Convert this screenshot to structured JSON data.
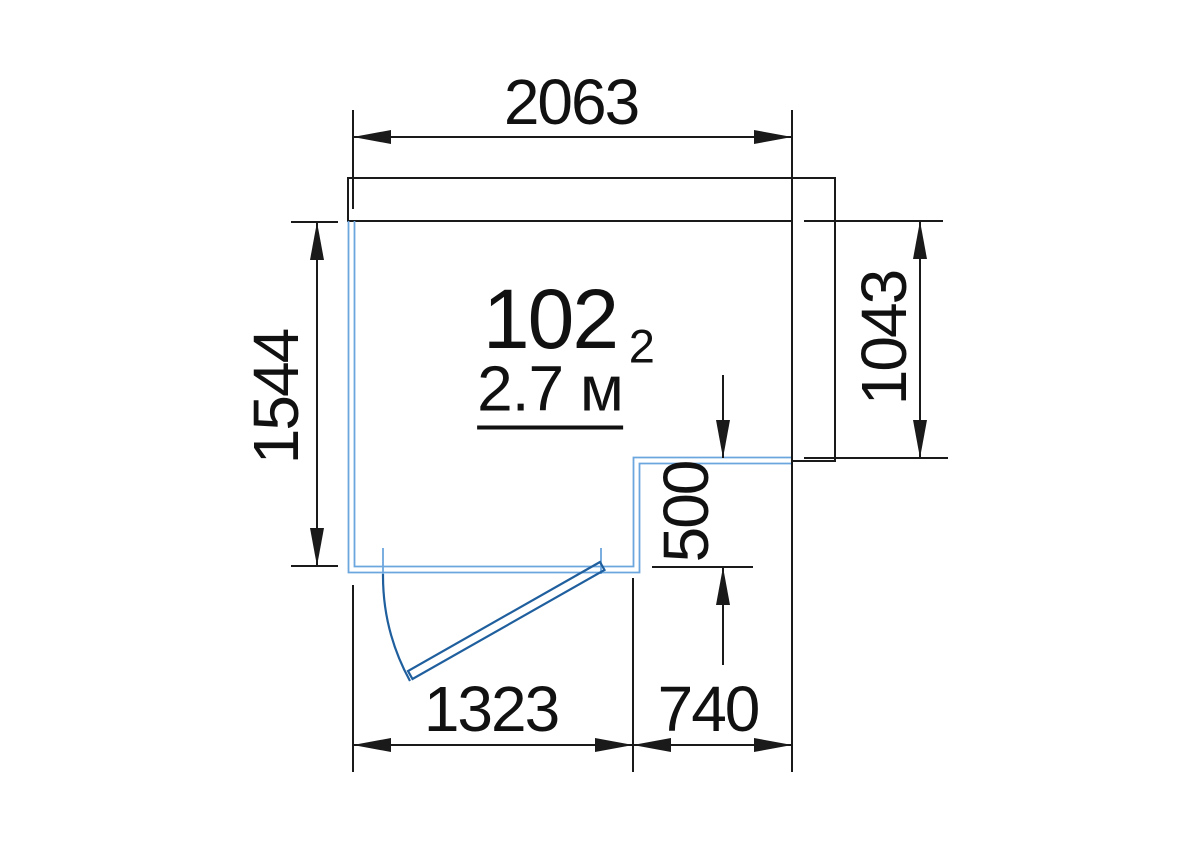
{
  "drawing": {
    "type": "floor-plan",
    "room": {
      "number": "102",
      "area_value": "2.7 м",
      "area_exponent": "2"
    },
    "dimensions": {
      "top_width": "2063",
      "left_height": "1544",
      "right_height": "1043",
      "step_depth": "500",
      "bottom_left_width": "1323",
      "bottom_right_width": "740"
    }
  },
  "colors": {
    "wall_blue": "#6CA6DE",
    "door_blue": "#1F5F9E",
    "line_black": "#1A1A1A",
    "background": "#FFFFFF"
  }
}
